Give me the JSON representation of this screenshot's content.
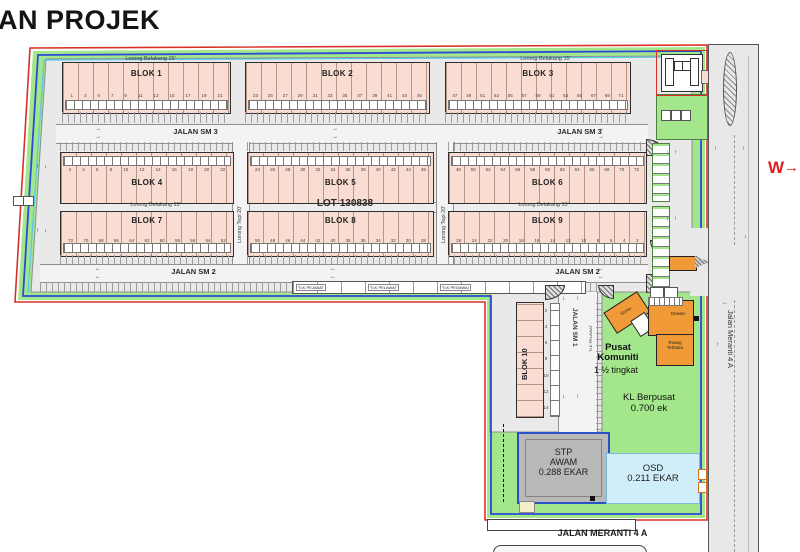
{
  "title": "AN PROJEK",
  "compass": {
    "label": "W",
    "arrow": "→"
  },
  "glyphs": {
    "up": "↑",
    "down": "↓",
    "left": "←",
    "right": "→"
  },
  "roads": {
    "jalan_sm3": "JALAN SM 3",
    "jalan_sm2": "JALAN SM 2",
    "jalan_sm1": "JALAN SM 1",
    "jalan_meranti_side": "Jalan Meranti 4 A",
    "jalan_meranti_bottom": "JALAN MERANTI 4 A",
    "lorong_belakang": "Lorong Belakang 15'",
    "lorong_tepi": "Lorong Tepi 20'"
  },
  "blocks": {
    "b1": {
      "label": "BLOK 1",
      "lots": [
        "1",
        "3",
        "5",
        "7",
        "9",
        "11",
        "13",
        "15",
        "17",
        "19",
        "21"
      ]
    },
    "b2": {
      "label": "BLOK 2",
      "lots": [
        "23",
        "25",
        "27",
        "29",
        "31",
        "33",
        "35",
        "37",
        "39",
        "41",
        "43",
        "45"
      ]
    },
    "b3": {
      "label": "BLOK 3",
      "lots": [
        "47",
        "49",
        "51",
        "53",
        "55",
        "57",
        "59",
        "61",
        "63",
        "65",
        "67",
        "69",
        "71"
      ]
    },
    "b4": {
      "label": "BLOK 4",
      "lots": [
        "2",
        "4",
        "6",
        "8",
        "10",
        "12",
        "14",
        "16",
        "18",
        "20",
        "22"
      ]
    },
    "b5": {
      "label": "BLOK 5",
      "lots": [
        "24",
        "26",
        "28",
        "30",
        "32",
        "34",
        "36",
        "38",
        "40",
        "42",
        "44",
        "46"
      ]
    },
    "b6": {
      "label": "BLOK 6",
      "lots": [
        "48",
        "50",
        "52",
        "54",
        "56",
        "58",
        "60",
        "62",
        "64",
        "66",
        "68",
        "70",
        "72"
      ]
    },
    "b7": {
      "label": "BLOK 7",
      "lots": [
        "72",
        "70",
        "68",
        "66",
        "64",
        "62",
        "60",
        "58",
        "56",
        "54",
        "52"
      ]
    },
    "b8": {
      "label": "BLOK 8",
      "lots": [
        "50",
        "48",
        "46",
        "44",
        "42",
        "40",
        "38",
        "36",
        "34",
        "32",
        "30",
        "28"
      ]
    },
    "b9": {
      "label": "BLOK 9",
      "lots": [
        "26",
        "24",
        "22",
        "20",
        "18",
        "16",
        "14",
        "12",
        "10",
        "8",
        "6",
        "4",
        "2"
      ]
    },
    "b10": {
      "label": "BLOK 10",
      "lots": [
        "2",
        "4",
        "6",
        "8",
        "10",
        "12",
        "14"
      ]
    }
  },
  "site": {
    "lot_number": "LOT 130838",
    "keluar": "KELUAR",
    "masuk": "MASUK",
    "pusat_line1": "Pusat",
    "pusat_line2": "Komuniti",
    "pusat_line3": "1 ½ tingkat",
    "surau": "Surau",
    "dewan": "Dewan",
    "ruang_line1": "Ruang",
    "ruang_line2": "Terbuka",
    "kl_line1": "KL Berpusat",
    "kl_line2": "0.700 ek",
    "stp_line1": "STP",
    "stp_line2": "AWAM",
    "stp_line3": "0.288 EKAR",
    "osd_line1": "OSD",
    "osd_line2": "0.211 EKAR",
    "tlk_labels": [
      "TLK PEJABAT",
      "TLK PELAWAT",
      "TLK PEGAWAI"
    ],
    "tlk_vertical": "TLK PELAWAT"
  },
  "colors": {
    "boundary_red": "#d93025",
    "boundary_blue": "#2b4bd7",
    "buffer_green": "#a3e68c",
    "block_fill": "#f9ddd2",
    "building_orange": "#f09a38",
    "osd_blue": "#d0eef9",
    "stp_gray": "#b9b9b9",
    "compass_red": "#e01f1f"
  }
}
